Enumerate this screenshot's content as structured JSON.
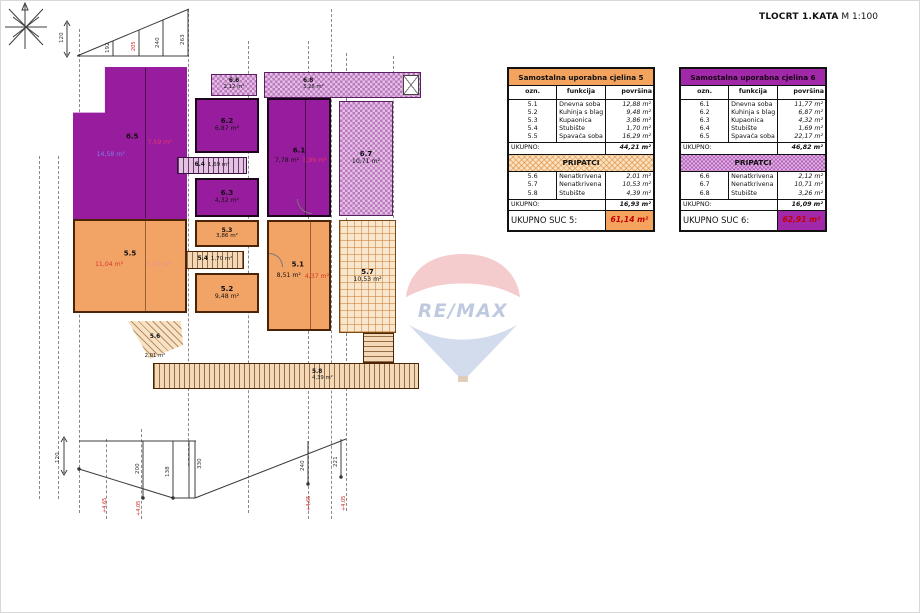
{
  "header": {
    "title_bold": "TLOCRT 1.KATA",
    "title_scale": "M 1:100"
  },
  "watermark": {
    "brand": "RE/MAX"
  },
  "plan": {
    "rooms": {
      "r6_5": {
        "id": "6.5",
        "blue": "14,58 m²",
        "red": "7,59 m²"
      },
      "r6_2": {
        "id": "6.2",
        "area": "6,87 m²"
      },
      "r6_4": {
        "id": "6.4",
        "area": "1,69 m²"
      },
      "r6_3": {
        "id": "6.3",
        "area": "4,32 m²"
      },
      "r6_1": {
        "id": "6.1",
        "area": "7,78 m²",
        "red": "3,99 m²"
      },
      "r6_6": {
        "id": "6.6",
        "area": "2,12 m²"
      },
      "r6_8": {
        "id": "6.8",
        "area": "3,26 m²"
      },
      "r6_7": {
        "id": "6.7",
        "area": "10,71 m²"
      },
      "r5_5": {
        "id": "5.5",
        "red": "11,04 m²",
        "pink": "5,25 m²"
      },
      "r5_3": {
        "id": "5.3",
        "area": "3,86 m²"
      },
      "r5_4": {
        "id": "5.4",
        "area": "1,70 m²"
      },
      "r5_2": {
        "id": "5.2",
        "area": "9,48 m²"
      },
      "r5_1": {
        "id": "5.1",
        "area": "8,51 m²",
        "red": "4,37 m²"
      },
      "r5_7": {
        "id": "5.7",
        "area": "10,53 m²"
      },
      "r5_6": {
        "id": "5.6",
        "area": "2,01 m²"
      },
      "r5_8": {
        "id": "5.8",
        "area": "4,39 m²"
      }
    },
    "dims": {
      "top": [
        "120",
        "192",
        "205",
        "240",
        "263"
      ],
      "bottom": [
        "120",
        "200",
        "138",
        "330",
        "240",
        "221"
      ]
    },
    "levels": [
      "+4,65",
      "+4,05",
      "+4,65",
      "+4,05"
    ]
  },
  "tables": [
    {
      "title": "Samostalna uporabna cjelina 5",
      "theme": "orange",
      "columns": [
        "ozn.",
        "funkcija",
        "površina"
      ],
      "rows": [
        [
          "5.1",
          "Dnevna soba",
          "12,88 m²"
        ],
        [
          "5.2",
          "Kuhinja s blagovaonicom",
          "9,48 m²"
        ],
        [
          "5.3",
          "Kupaonica",
          "3,86 m²"
        ],
        [
          "5.4",
          "Stubište",
          "1,70 m²"
        ],
        [
          "5.5",
          "Spavaća soba",
          "16,29 m²"
        ]
      ],
      "subtotal_label": "UKUPNO:",
      "subtotal": "44,21 m²",
      "section": "PRIPATCI",
      "rows2": [
        [
          "5.6",
          "Nenatkrivena terasa",
          "2,01 m²"
        ],
        [
          "5.7",
          "Nenatkrivena terasa",
          "10,53 m²"
        ],
        [
          "5.8",
          "Stubište",
          "4,39 m²"
        ]
      ],
      "subtotal2_label": "UKUPNO:",
      "subtotal2": "16,93 m²",
      "total_label": "UKUPNO SUC 5:",
      "total": "61,14 m²"
    },
    {
      "title": "Samostalna uporabna cjelina 6",
      "theme": "purpleT",
      "columns": [
        "ozn.",
        "funkcija",
        "površina"
      ],
      "rows": [
        [
          "6.1",
          "Dnevna soba",
          "11,77 m²"
        ],
        [
          "6.2",
          "Kuhinja s blagovaonicom",
          "6,87 m²"
        ],
        [
          "6.3",
          "Kupaonica",
          "4,32 m²"
        ],
        [
          "6.4",
          "Stubište",
          "1,69 m²"
        ],
        [
          "6.5",
          "Spavaća soba",
          "22,17 m²"
        ]
      ],
      "subtotal_label": "UKUPNO:",
      "subtotal": "46,82 m²",
      "section": "PRIPATCI",
      "rows2": [
        [
          "6.6",
          "Nenatkrivena terasa",
          "2,12 m²"
        ],
        [
          "6.7",
          "Nenatkrivena terasa",
          "10,71 m²"
        ],
        [
          "6.8",
          "Stubište",
          "3,26 m²"
        ]
      ],
      "subtotal2_label": "UKUPNO:",
      "subtotal2": "16,09 m²",
      "total_label": "UKUPNO SUC 6:",
      "total": "62,91 m²"
    }
  ]
}
